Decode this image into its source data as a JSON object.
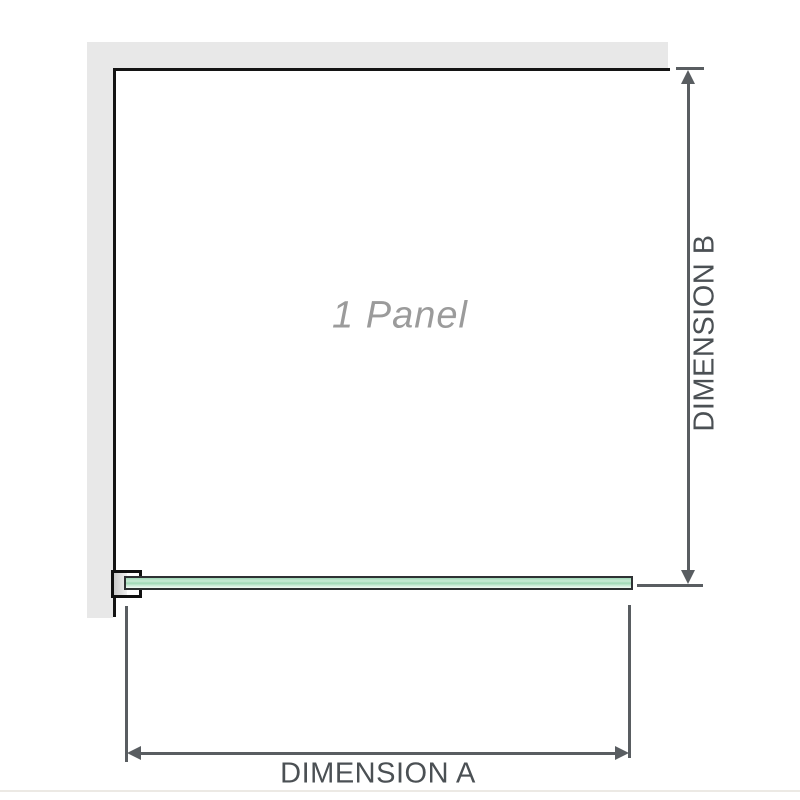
{
  "diagram": {
    "panel_label": "1 Panel",
    "dimension_a_label": "DIMENSION A",
    "dimension_b_label": "DIMENSION B"
  },
  "colors": {
    "wall": "#e8e8e8",
    "panel_outline": "#141414",
    "dimension": "#595d61",
    "label_text": "#4b5054",
    "panel_text": "#9b9b9b",
    "glass_light": "#c9ead6",
    "glass_mid": "#9fd8b6",
    "glass_dark_edge": "#2e3133"
  }
}
